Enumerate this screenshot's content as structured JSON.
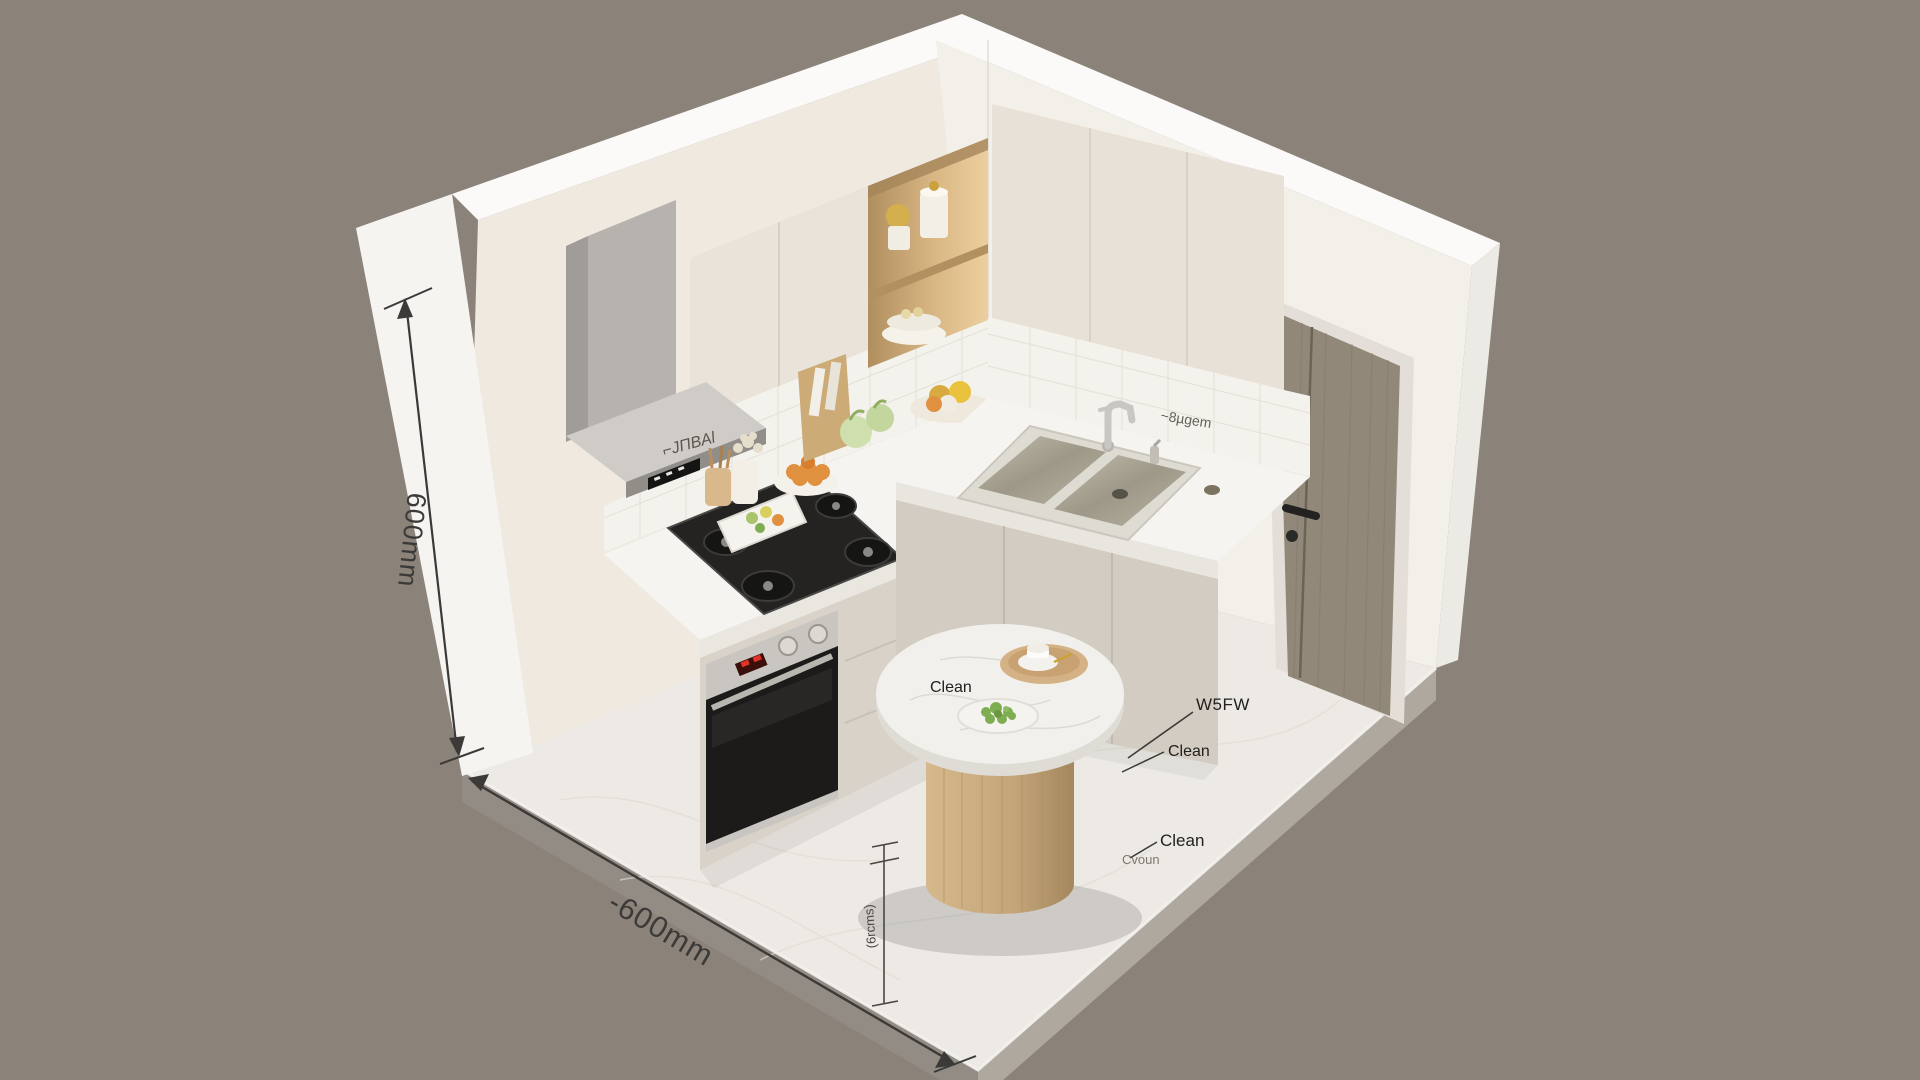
{
  "scene": {
    "type": "isometric-kitchen-3d-render",
    "annotations": {
      "wall_height_label": "600mm",
      "floor_width_label": "-600mm",
      "floor_small_label": "(6rcms)",
      "table_label": "Clean",
      "floor_label_mid": "Clean",
      "floor_label_low": "Clean",
      "floor_label_faded": "Cvoun",
      "floor_code_label": "W5FW",
      "tile_label_left": "⌐JΠBAl",
      "tile_label_right": "~8µgem"
    },
    "colors": {
      "background": "#8b8279",
      "wall_white": "#f6f4f1",
      "wall_top": "#fbfaf8",
      "interior_wall_left": "#efe9e0",
      "interior_wall_right": "#f3f0ea",
      "floor_marble": "#edeae5",
      "slab_side_left": "#938c84",
      "slab_side_right": "#aea89f",
      "counter_top": "#f6f4f0",
      "cabinet_upper": "#e9e3d9",
      "cabinet_lower_left": "#d8d2c8",
      "cabinet_lower_right": "#d2ccc2",
      "niche_wood_light": "#eccf9f",
      "door_wood": "#91887a",
      "table_wood": "#c5a87e",
      "cooktop_black": "#242322",
      "oven_glass": "#1c1b1a",
      "steel": "#c9c6c1",
      "led_glow": "#fff3d8",
      "annotation_ink": "#3b3a38",
      "greens": "#7fae52",
      "eggs_orange": "#e0913f",
      "oven_display_red": "#e33326"
    }
  }
}
